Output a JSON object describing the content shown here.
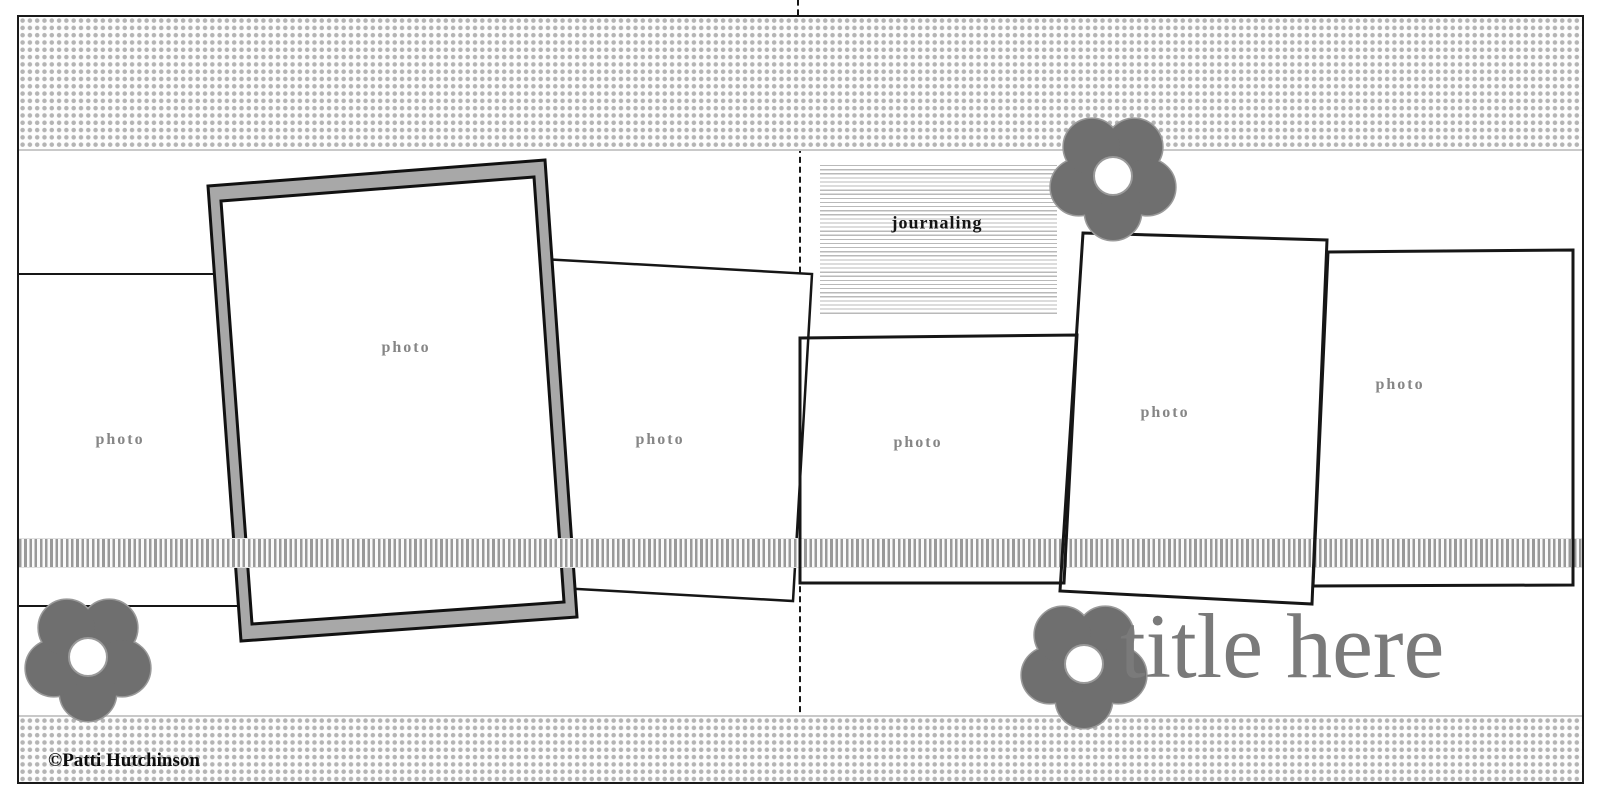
{
  "page": {
    "type": "two-page scrapbook layout sketch",
    "title": "title here",
    "credit": "©Patti Hutchinson"
  },
  "labels": {
    "photo": "photo",
    "journaling": "journaling"
  },
  "photos": [
    {
      "id": 1,
      "side": "left",
      "label": "photo"
    },
    {
      "id": 2,
      "side": "left",
      "label": "photo",
      "matted": true
    },
    {
      "id": 3,
      "side": "left",
      "label": "photo"
    },
    {
      "id": 4,
      "side": "right",
      "label": "photo"
    },
    {
      "id": 5,
      "side": "right",
      "label": "photo"
    },
    {
      "id": 6,
      "side": "right",
      "label": "photo"
    }
  ],
  "embellishments": {
    "flowers": 3,
    "ribbon": "striped horizontal ribbon",
    "patterned_paper": "dotted bands top and bottom"
  },
  "colors": {
    "flower": "#6f6f6f",
    "flower_outline": "#9a9a9a",
    "mat_gray": "#a8a8a8",
    "title_gray": "#7a7a7a",
    "label_gray": "#868686",
    "pattern_dot": "#b4b4b4",
    "ribbon_stripe": "#999999",
    "journal_line": "#b9b9b9",
    "outline_black": "#161616"
  }
}
